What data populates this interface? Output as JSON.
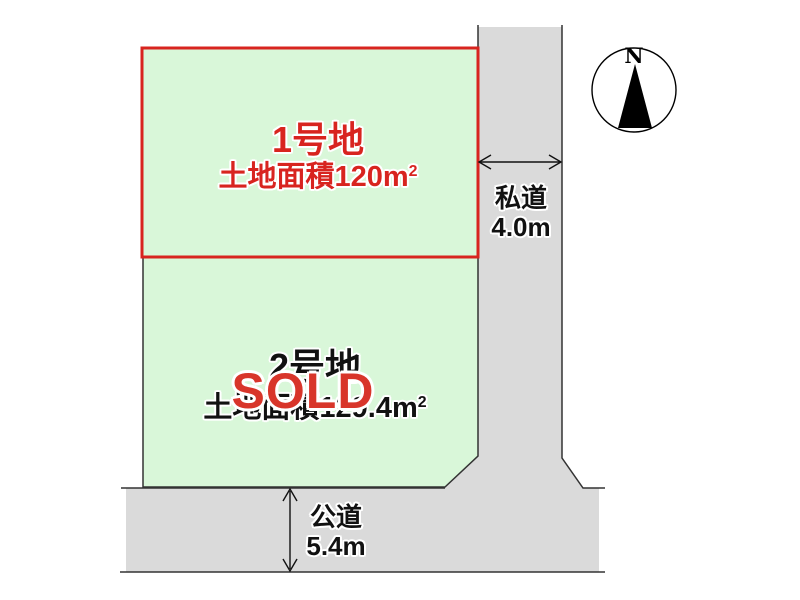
{
  "colors": {
    "background": "#ffffff",
    "plot_fill": "#d9f7d9",
    "road_fill": "#dadada",
    "plot1_border_red": "#d8241f",
    "sold_red": "#d8352a",
    "line_dark": "#333333",
    "text_black": "#111111"
  },
  "plot1": {
    "name": "1号地",
    "area_prefix": "土地面積120",
    "area_unit": "m",
    "area_exponent": "2"
  },
  "plot2": {
    "name": "2号地",
    "area_prefix": "土地面積129.4",
    "area_unit": "m",
    "area_exponent": "2",
    "status": "SOLD"
  },
  "roads": {
    "private": {
      "name": "私道",
      "width": "4.0m"
    },
    "public": {
      "name": "公道",
      "width": "5.4m"
    }
  },
  "compass": {
    "north": "N"
  }
}
